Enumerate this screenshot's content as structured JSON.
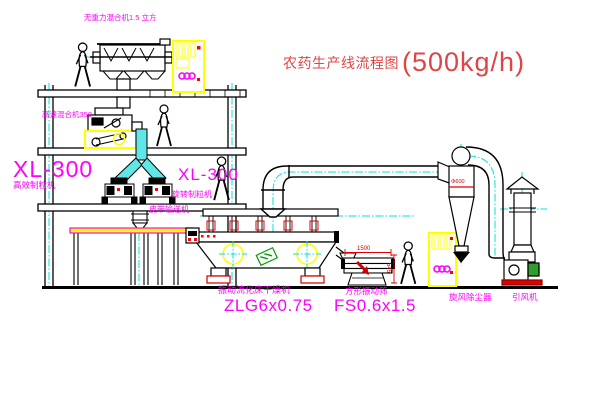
{
  "title": {
    "name": "农药生产线流程图",
    "capacity": "(500kg/h)"
  },
  "labels": {
    "gravity_mixer": "无重力混合机1.5 立方",
    "speed_mixer": "高速混合机350",
    "xl300_left": "XL-300",
    "granulator_left": "高效制粒机",
    "xl300_right": "XL-300",
    "granulator_right": "旋转制粒机",
    "conveyor": "皮带输送机",
    "dryer": "振动流化床干燥机",
    "dryer_model": "ZLG6x0.75",
    "sieve": "方形振动筛",
    "sieve_model": "FS0.6x1.5",
    "cyclone": "旋风除尘器",
    "fan": "引风机"
  },
  "dims": {
    "sieve_w": "1500",
    "sieve_h": "545",
    "cyclone_d": "Φ600"
  },
  "colors": {
    "label_magenta": "#ff00ff",
    "title_red": "#e04545",
    "dimension_red": "#e00000",
    "centerline_cyan": "#00e0e0",
    "cabinet_yellow": "#ffff00",
    "motor_green": "#2f9e2f",
    "line_black": "#000000"
  }
}
